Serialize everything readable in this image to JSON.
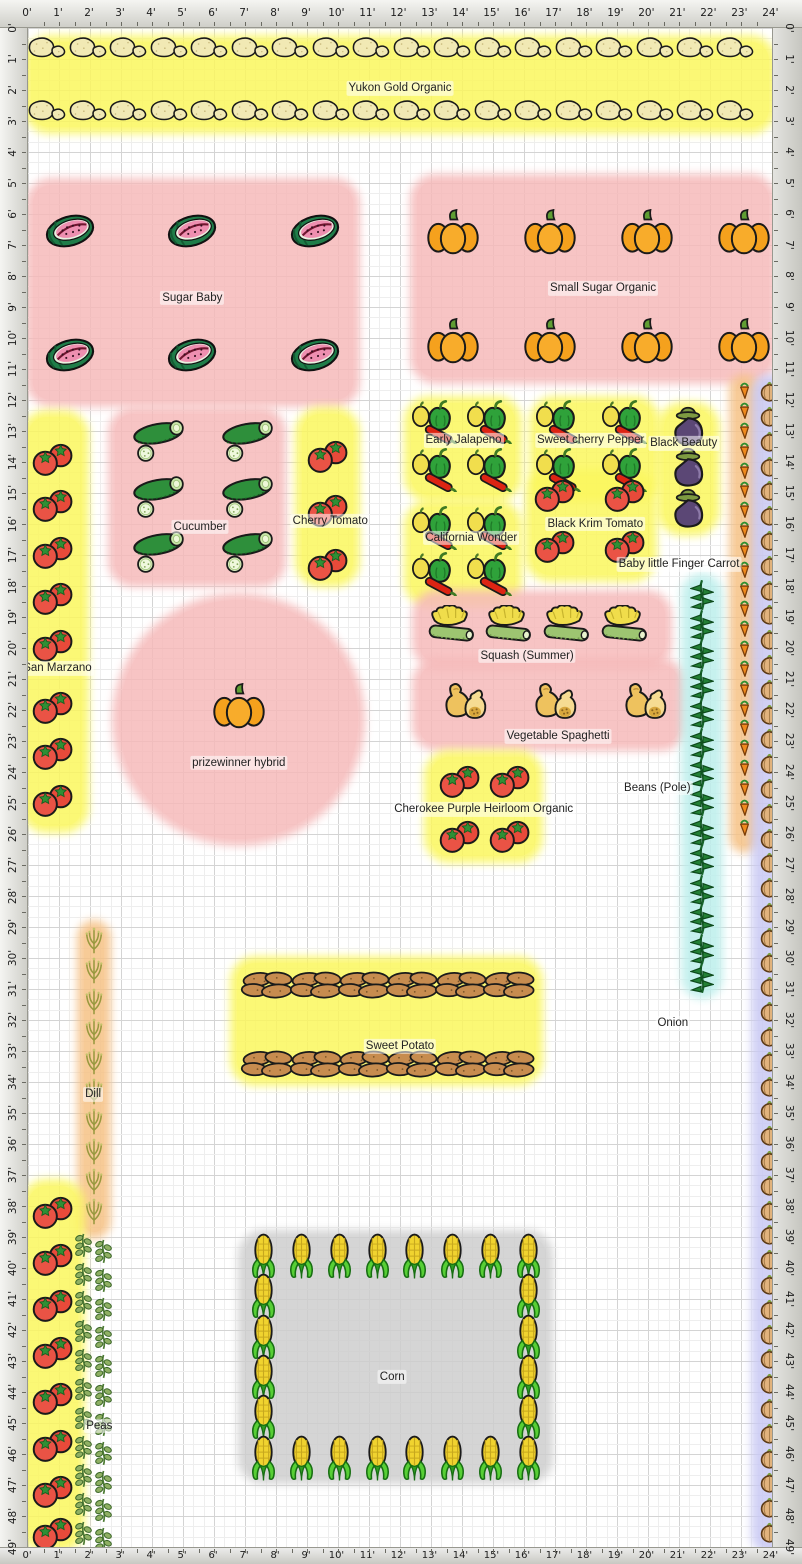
{
  "meta": {
    "cell_px": 31,
    "origin_px": 28,
    "cols": 24,
    "rows": 49,
    "unit": "feet"
  },
  "palette": {
    "bed_yellow": "#fbf75e",
    "bed_pink": "#f6baba",
    "bed_cyan": "#bdefec",
    "bed_lavender": "#c9c9f4",
    "bed_orange": "#f6c286",
    "bed_gray": "#cecece",
    "grid_minor": "#eeeeee",
    "grid_major": "#d4d4d4",
    "ruler_text": "#1d1d1d"
  },
  "rulers": {
    "h_labels": [
      "0'",
      "1'",
      "2'",
      "3'",
      "4'",
      "5'",
      "6'",
      "7'",
      "8'",
      "9'",
      "10'",
      "11'",
      "12'",
      "13'",
      "14'",
      "15'",
      "16'",
      "17'",
      "18'",
      "19'",
      "20'",
      "21'",
      "22'",
      "23'",
      "24'"
    ],
    "v_labels": [
      "0'",
      "1'",
      "2'",
      "3'",
      "4'",
      "5'",
      "6'",
      "7'",
      "8'",
      "9'",
      "10'",
      "11'",
      "12'",
      "13'",
      "14'",
      "15'",
      "16'",
      "17'",
      "18'",
      "19'",
      "20'",
      "21'",
      "22'",
      "23'",
      "24'",
      "25'",
      "26'",
      "27'",
      "28'",
      "29'",
      "30'",
      "31'",
      "32'",
      "33'",
      "34'",
      "35'",
      "36'",
      "37'",
      "38'",
      "39'",
      "40'",
      "41'",
      "42'",
      "43'",
      "44'",
      "45'",
      "46'",
      "47'",
      "48'",
      "49'"
    ]
  },
  "beds": [
    {
      "id": "yukon-gold",
      "label": "Yukon Gold Organic",
      "icon": "potato",
      "color": "bed_yellow",
      "shape": "rect",
      "rect": [
        0.1,
        0.45,
        23.8,
        2.75
      ],
      "label_at": [
        12.0,
        1.95
      ],
      "icons": {
        "grid": {
          "x0": 0.62,
          "y0": 0.62,
          "dx": 1.306,
          "dy": 2.05,
          "cols": 18,
          "rows": 2
        }
      }
    },
    {
      "id": "sugar-baby",
      "label": "Sugar Baby",
      "icon": "watermelon",
      "color": "bed_pink",
      "shape": "rect",
      "rect": [
        0.15,
        5.05,
        10.35,
        6.95
      ],
      "label_at": [
        5.3,
        8.7
      ],
      "icons": {
        "grid": {
          "x0": 1.35,
          "y0": 6.55,
          "dx": 3.95,
          "dy": 4.0,
          "cols": 3,
          "rows": 2
        }
      }
    },
    {
      "id": "small-sugar",
      "label": "Small Sugar Organic",
      "icon": "pumpkin",
      "color": "bed_pink",
      "shape": "rect",
      "rect": [
        12.55,
        4.95,
        11.35,
        6.3
      ],
      "label_at": [
        18.55,
        8.4
      ],
      "icons": {
        "grid": {
          "x0": 13.7,
          "y0": 6.6,
          "dx": 3.13,
          "dy": 3.5,
          "cols": 4,
          "rows": 2
        }
      }
    },
    {
      "id": "early-jalapeno",
      "label": "Early Jalapeno",
      "icon": "pepper",
      "color": "bed_yellow",
      "shape": "rect",
      "rect": [
        12.35,
        12.1,
        3.35,
        2.95
      ],
      "label_at": [
        14.05,
        13.3
      ],
      "icons": {
        "grid": {
          "x0": 13.15,
          "y0": 12.65,
          "dx": 1.8,
          "dy": 1.55,
          "cols": 2,
          "rows": 2
        }
      }
    },
    {
      "id": "sweet-cherry-pepper",
      "label": "Sweet cherry Pepper",
      "icon": "pepper",
      "color": "bed_yellow",
      "shape": "rect",
      "rect": [
        16.4,
        12.1,
        3.75,
        2.95
      ],
      "label_at": [
        18.15,
        13.3
      ],
      "icons": {
        "grid": {
          "x0": 17.15,
          "y0": 12.65,
          "dx": 2.15,
          "dy": 1.55,
          "cols": 2,
          "rows": 2
        }
      }
    },
    {
      "id": "black-beauty",
      "label": "Black Beauty",
      "icon": "eggplant",
      "color": "bed_yellow",
      "shape": "rect",
      "rect": [
        20.5,
        12.3,
        1.6,
        3.85
      ],
      "label_at": [
        21.15,
        13.4
      ],
      "icons": {
        "grid": {
          "x0": 21.28,
          "y0": 12.85,
          "dx": 1,
          "dy": 1.32,
          "cols": 1,
          "rows": 3
        }
      }
    },
    {
      "id": "california-wonder",
      "label": "California Wonder",
      "icon": "pepper",
      "color": "bed_yellow",
      "shape": "rect",
      "rect": [
        12.35,
        15.45,
        3.35,
        3.0
      ],
      "label_at": [
        14.3,
        16.45
      ],
      "icons": {
        "grid": {
          "x0": 13.15,
          "y0": 16.05,
          "dx": 1.8,
          "dy": 1.5,
          "cols": 2,
          "rows": 2
        }
      }
    },
    {
      "id": "black-krim",
      "label": "Black Krim Tomato",
      "icon": "tomato",
      "color": "bed_yellow",
      "shape": "rect",
      "rect": [
        16.25,
        14.45,
        3.8,
        3.2
      ],
      "label_at": [
        18.3,
        16.0
      ],
      "icons": {
        "grid": {
          "x0": 17.0,
          "y0": 15.05,
          "dx": 2.25,
          "dy": 1.65,
          "cols": 2,
          "rows": 2
        }
      }
    },
    {
      "id": "baby-carrot",
      "label": "Baby little Finger Carrot",
      "icon": "carrot",
      "color": "bed_orange",
      "shape": "rect",
      "rect": [
        22.85,
        11.4,
        0.55,
        15.0
      ],
      "label_at": [
        21.0,
        17.3
      ],
      "icons": {
        "column": {
          "x": 23.12,
          "y0": 11.7,
          "dy": 0.64,
          "count": 23
        }
      }
    },
    {
      "id": "onion",
      "label": "Onion",
      "icon": "onion",
      "color": "bed_lavender",
      "shape": "rect",
      "rect": [
        23.55,
        11.4,
        0.75,
        37.6
      ],
      "label_at": [
        20.8,
        32.1
      ],
      "icons": {
        "column": {
          "x": 23.92,
          "y0": 11.7,
          "dy": 0.8,
          "count": 47
        }
      }
    },
    {
      "id": "cucumber",
      "label": "Cucumber",
      "icon": "cucumber",
      "color": "bed_pink",
      "shape": "rect",
      "rect": [
        2.8,
        12.45,
        5.3,
        5.35
      ],
      "label_at": [
        5.55,
        16.1
      ],
      "icons": {
        "grid": {
          "x0": 4.3,
          "y0": 13.35,
          "dx": 2.85,
          "dy": 1.78,
          "cols": 2,
          "rows": 3
        }
      }
    },
    {
      "id": "cherry-tomato",
      "label": "Cherry Tomato",
      "icon": "tomato",
      "color": "bed_yellow",
      "shape": "rect",
      "rect": [
        8.85,
        12.45,
        1.65,
        5.35
      ],
      "label_at": [
        9.75,
        15.9
      ],
      "icons": {
        "grid": {
          "x0": 9.67,
          "y0": 13.8,
          "dx": 1,
          "dy": 1.75,
          "cols": 1,
          "rows": 3
        }
      }
    },
    {
      "id": "san-marzano",
      "label": "San Marzano",
      "icon": "tomato",
      "color": "bed_yellow",
      "shape": "rect",
      "rect": [
        0.0,
        12.55,
        1.75,
        13.2
      ],
      "label_at": [
        0.95,
        20.65
      ],
      "icons": {
        "positions": [
          [
            0.8,
            13.9
          ],
          [
            0.8,
            15.4
          ],
          [
            0.8,
            16.9
          ],
          [
            0.8,
            18.4
          ],
          [
            0.8,
            19.9
          ],
          [
            0.8,
            21.9
          ],
          [
            0.8,
            23.4
          ],
          [
            0.8,
            24.9
          ]
        ]
      }
    },
    {
      "id": "prizewinner",
      "label": "prizewinner hybrid",
      "icon": "pumpkin",
      "color": "bed_pink",
      "shape": "circle",
      "rect": [
        2.95,
        18.45,
        7.7,
        7.7
      ],
      "label_at": [
        6.8,
        23.7
      ],
      "icons": {
        "positions": [
          [
            6.8,
            21.9
          ]
        ]
      }
    },
    {
      "id": "squash-summer",
      "label": "Squash (Summer)",
      "icon": "squash",
      "color": "bed_pink",
      "shape": "rect",
      "rect": [
        12.6,
        18.35,
        7.95,
        2.1
      ],
      "label_at": [
        16.1,
        20.25
      ],
      "icons": {
        "grid": {
          "x0": 13.7,
          "y0": 19.25,
          "dx": 1.86,
          "dy": 1,
          "cols": 4,
          "rows": 1
        }
      }
    },
    {
      "id": "veg-spaghetti",
      "label": "Vegetable Spaghetti",
      "icon": "spaghetti",
      "color": "bed_pink",
      "shape": "rect",
      "rect": [
        12.6,
        20.55,
        8.4,
        2.55
      ],
      "label_at": [
        17.1,
        22.85
      ],
      "icons": {
        "grid": {
          "x0": 14.0,
          "y0": 21.75,
          "dx": 2.9,
          "dy": 1,
          "cols": 3,
          "rows": 1
        }
      }
    },
    {
      "id": "cherokee-purple",
      "label": "Cherokee Purple Heirloom Organic",
      "icon": "tomato",
      "color": "bed_yellow",
      "shape": "rect",
      "rect": [
        13.0,
        23.5,
        3.4,
        3.2
      ],
      "label_at": [
        14.7,
        25.2
      ],
      "icons": {
        "grid": {
          "x0": 13.95,
          "y0": 24.3,
          "dx": 1.6,
          "dy": 1.75,
          "cols": 2,
          "rows": 2
        }
      }
    },
    {
      "id": "beans-pole",
      "label": "Beans (Pole)",
      "icon": "bean",
      "color": "bed_cyan",
      "shape": "rect",
      "rect": [
        21.3,
        17.8,
        0.9,
        13.3
      ],
      "label_at": [
        20.3,
        24.5
      ],
      "icons": {
        "column": {
          "x": 21.75,
          "y0": 18.3,
          "dy": 0.95,
          "count": 14
        }
      }
    },
    {
      "id": "sweet-potato",
      "label": "Sweet Potato",
      "icon": "sweetpotato",
      "color": "bed_yellow",
      "shape": "rect",
      "rect": [
        6.75,
        30.15,
        9.65,
        3.75
      ],
      "label_at": [
        12.0,
        32.85
      ],
      "icons": {
        "grid": {
          "x0": 7.75,
          "y0": 30.85,
          "dx": 1.56,
          "dy": 2.55,
          "cols": 6,
          "rows": 2
        }
      }
    },
    {
      "id": "dill",
      "label": "Dill",
      "icon": "dill",
      "color": "bed_orange",
      "shape": "rect",
      "rect": [
        1.8,
        29.0,
        0.65,
        9.85
      ],
      "label_at": [
        2.1,
        34.4
      ],
      "icons": {
        "column": {
          "x": 2.12,
          "y0": 29.4,
          "dy": 0.97,
          "count": 10
        }
      }
    },
    {
      "id": "corn",
      "label": "Corn",
      "icon": "corn",
      "color": "bed_gray",
      "shape": "rect",
      "rect": [
        7.0,
        39.0,
        9.7,
        7.75
      ],
      "label_at": [
        11.75,
        43.5
      ],
      "icons": {
        "positions": [
          [
            7.6,
            39.65
          ],
          [
            8.82,
            39.65
          ],
          [
            10.04,
            39.65
          ],
          [
            11.26,
            39.65
          ],
          [
            12.48,
            39.65
          ],
          [
            13.7,
            39.65
          ],
          [
            14.92,
            39.65
          ],
          [
            16.14,
            39.65
          ],
          [
            7.6,
            40.95
          ],
          [
            7.6,
            42.25
          ],
          [
            7.6,
            43.55
          ],
          [
            7.6,
            44.85
          ],
          [
            7.6,
            46.15
          ],
          [
            16.14,
            40.95
          ],
          [
            16.14,
            42.25
          ],
          [
            16.14,
            43.55
          ],
          [
            16.14,
            44.85
          ],
          [
            16.14,
            46.15
          ],
          [
            8.82,
            46.15
          ],
          [
            10.04,
            46.15
          ],
          [
            11.26,
            46.15
          ],
          [
            12.48,
            46.15
          ],
          [
            13.7,
            46.15
          ],
          [
            14.92,
            46.15
          ]
        ]
      }
    },
    {
      "id": "tomato-row-south",
      "label": "",
      "icon": "tomato",
      "color": "bed_yellow",
      "shape": "rect",
      "rect": [
        0.0,
        37.35,
        1.6,
        11.6
      ],
      "label_at": [
        0.8,
        43.0
      ],
      "icons": {
        "positions": [
          [
            0.8,
            38.2
          ],
          [
            0.8,
            39.7
          ],
          [
            0.8,
            41.2
          ],
          [
            0.8,
            42.7
          ],
          [
            0.8,
            44.2
          ],
          [
            0.8,
            45.7
          ],
          [
            0.8,
            47.2
          ],
          [
            0.8,
            48.55
          ]
        ]
      }
    },
    {
      "id": "peas",
      "label": "Peas",
      "icon": "pea",
      "color": "none",
      "shape": "rect",
      "rect": [
        1.5,
        39.1,
        1.2,
        10.0
      ],
      "label_at": [
        2.3,
        45.1
      ],
      "icons": {
        "columns": [
          {
            "x": 1.78,
            "y0": 39.25,
            "dy": 0.93,
            "count": 11
          },
          {
            "x": 2.42,
            "y0": 39.45,
            "dy": 0.93,
            "count": 11
          }
        ]
      }
    }
  ]
}
